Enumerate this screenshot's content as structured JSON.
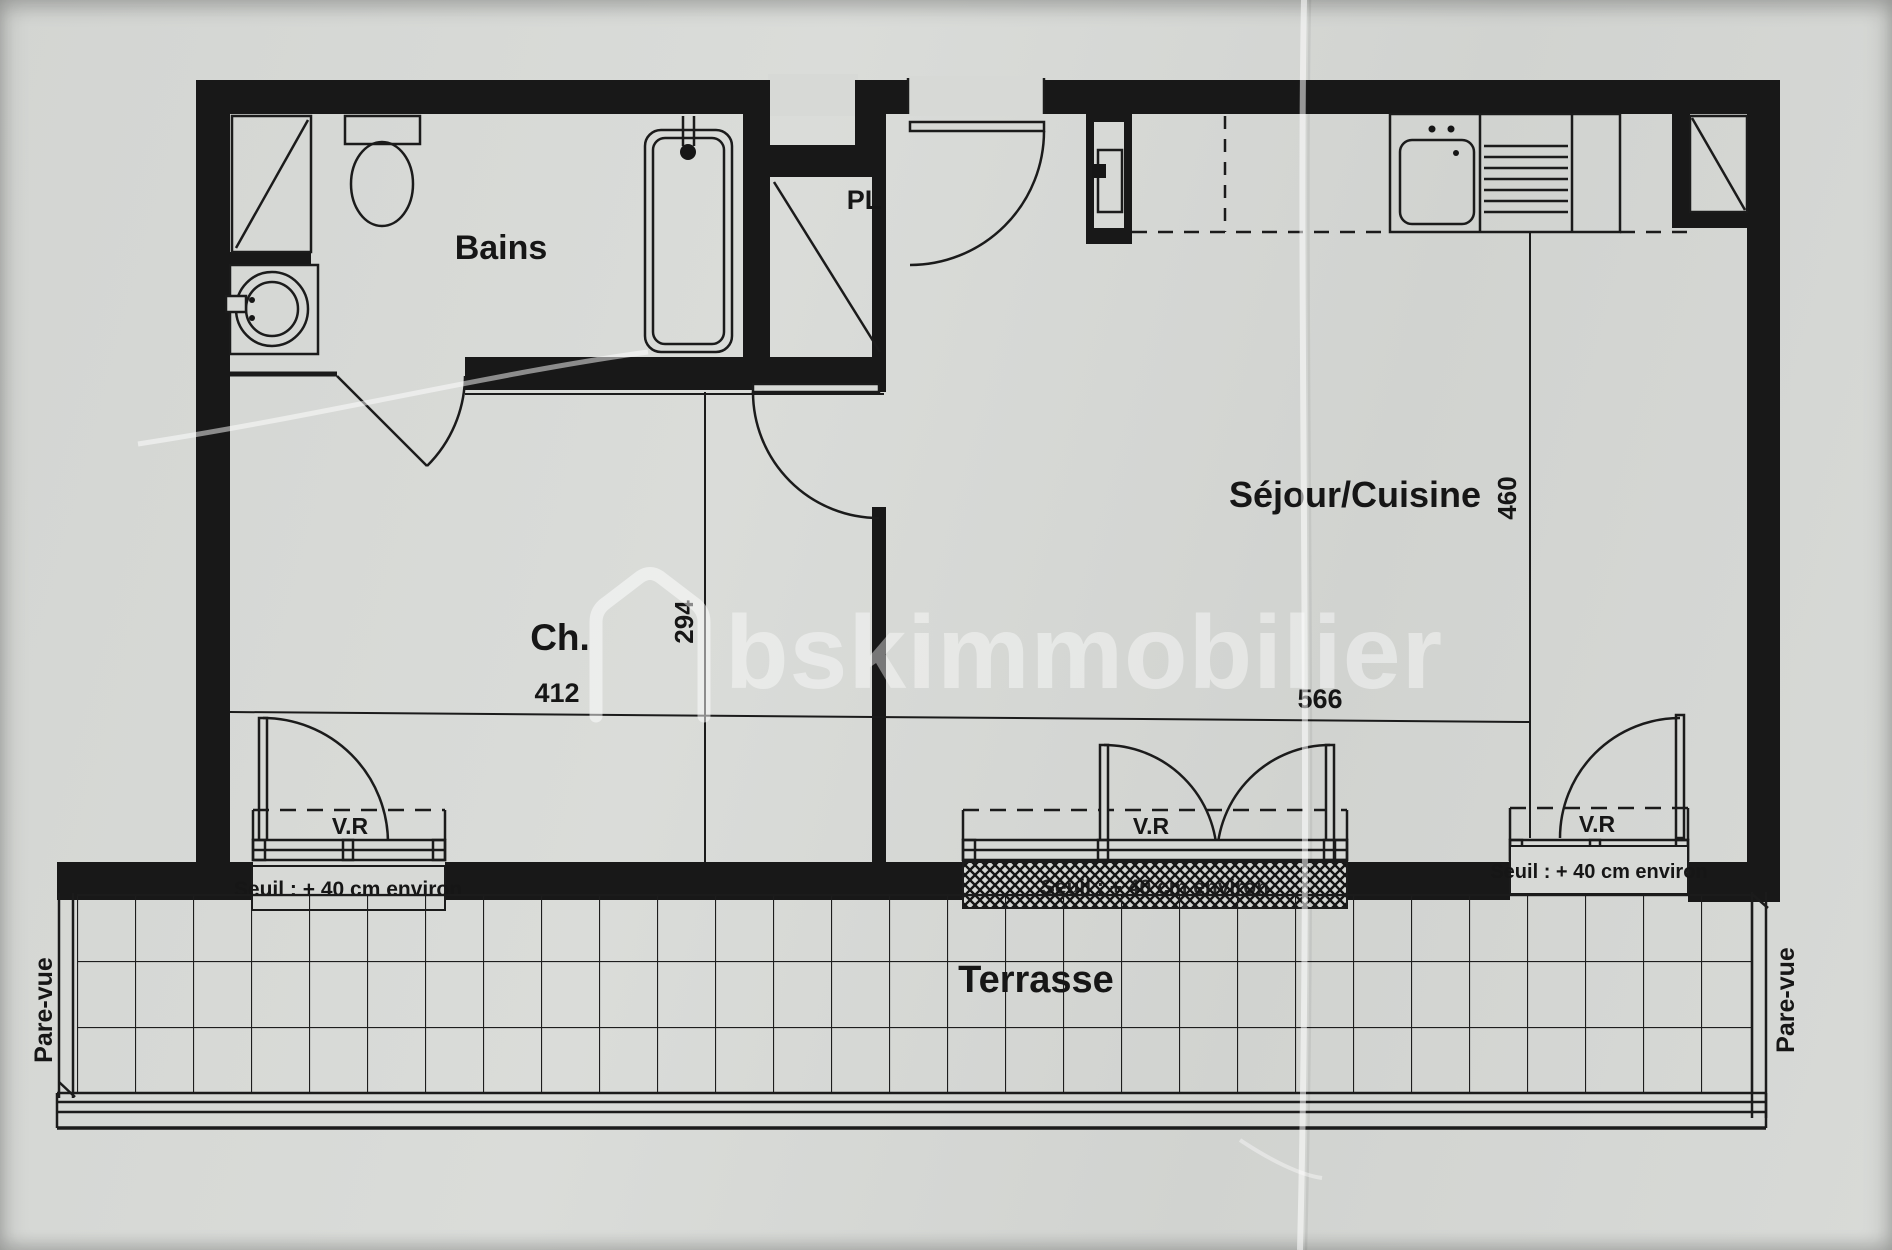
{
  "labels": {
    "bathroom": "Bains",
    "closet": "PL",
    "bedroom": "Ch.",
    "living_kitchen": "Séjour/Cuisine",
    "terrace": "Terrasse",
    "roller_shutter": "V.R",
    "sill_note": "Seuil : + 40 cm environ",
    "privacy_screen": "Pare-vue"
  },
  "dimensions_cm": {
    "bedroom_width": "412",
    "bedroom_depth": "294",
    "living_width": "566",
    "living_depth": "460"
  },
  "watermark": {
    "brand": "bskimmobilier"
  },
  "colors": {
    "paper": "#d7d9d6",
    "ink": "#1a1a1a"
  }
}
